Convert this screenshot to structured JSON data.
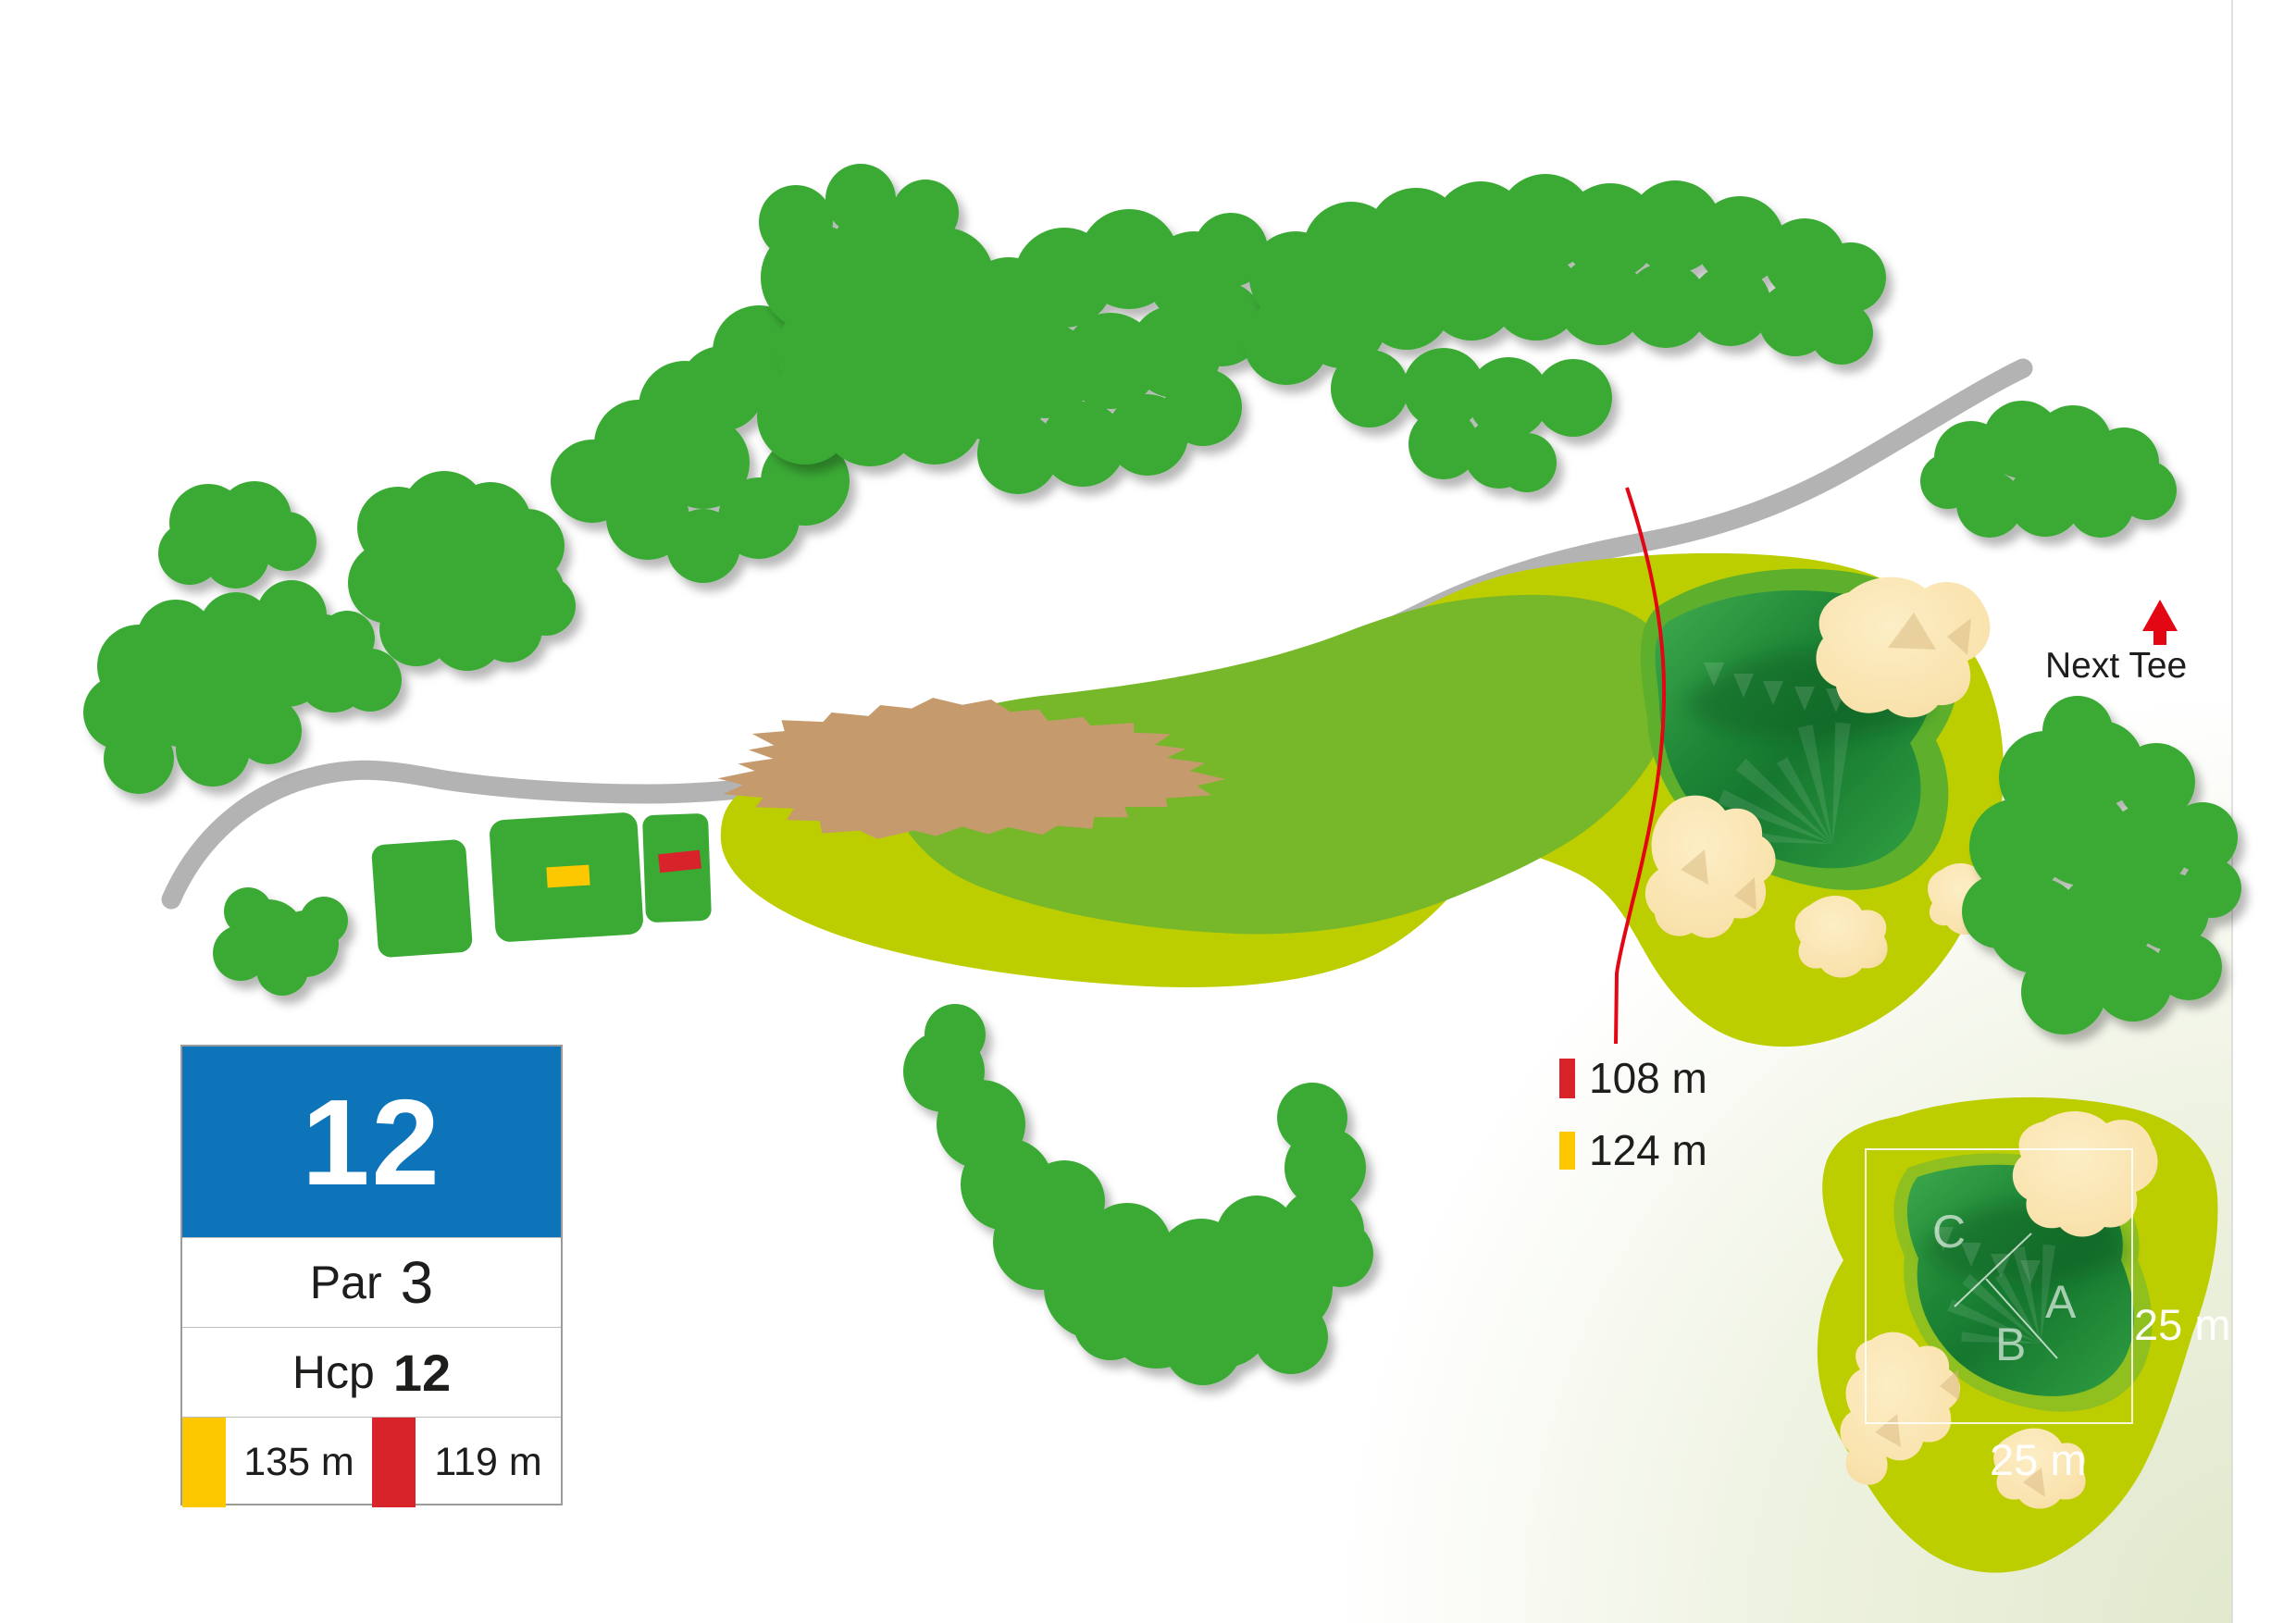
{
  "scorecard": {
    "hole_number": "12",
    "par_label": "Par",
    "par_value": "3",
    "hcp_label": "Hcp",
    "hcp_value": "12",
    "yellow_tee_distance": "135 m",
    "red_tee_distance": "119 m"
  },
  "distance_markers": {
    "red_line_distance": "108 m",
    "yellow_line_distance": "124 m"
  },
  "next_tee": {
    "label": "Next Tee"
  },
  "green_inset": {
    "pin_a": "A",
    "pin_b": "B",
    "pin_c": "C",
    "green_width": "25 m",
    "green_depth": "25 m"
  },
  "colors": {
    "header_blue": "#0e74ba",
    "tee_yellow": "#fdc800",
    "marker_red": "#d8232a",
    "arrow_red": "#e30613",
    "tree_green": "#3aaa35",
    "fairway_light": "#bdce00",
    "fairway_core": "#76b82a",
    "green_fringe": "#5eb02c",
    "green_surface": "#2f9e41",
    "bunker_sand": "#f9e2ac",
    "rough_brown": "#c59a6d",
    "path_gray": "#b3b3b3"
  }
}
